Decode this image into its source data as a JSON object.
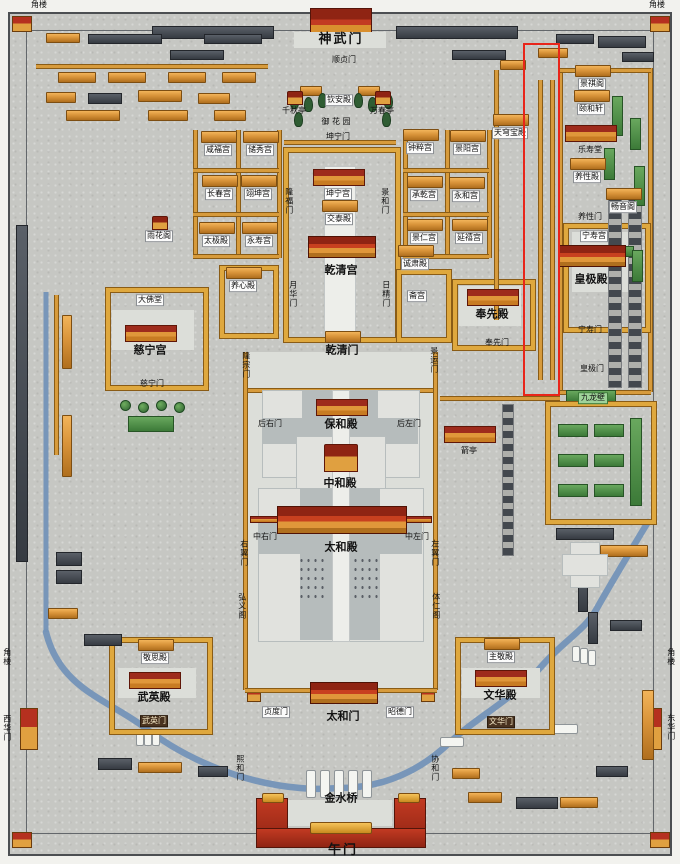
{
  "map": {
    "palette": {
      "ground": "#c6c7c3",
      "building_orange": "#d9943a",
      "roof_red": "#9e2b1c",
      "roof_dark": "#3f444a",
      "roof_green": "#3c7a38",
      "river_blue": "#7494b8",
      "marble": "#e1e2de",
      "annotation_red": "#e8251a"
    },
    "annotation_box": {
      "x": 523,
      "y": 43,
      "width": 33,
      "height": 349
    },
    "labels": [
      {
        "t": "角楼",
        "x": 39,
        "y": 5,
        "s": "t"
      },
      {
        "t": "角楼",
        "x": 657,
        "y": 5,
        "s": "t"
      },
      {
        "t": "角楼",
        "x": 7,
        "y": 657,
        "s": "t",
        "o": "v"
      },
      {
        "t": "角楼",
        "x": 671,
        "y": 657,
        "s": "t",
        "o": "v"
      },
      {
        "t": "西华门",
        "x": 7,
        "y": 728,
        "s": "t",
        "o": "v"
      },
      {
        "t": "东华门",
        "x": 671,
        "y": 727,
        "s": "t",
        "o": "v"
      },
      {
        "t": "神武门",
        "x": 341,
        "y": 40,
        "s": "h"
      },
      {
        "t": "顺贞门",
        "x": 344,
        "y": 60,
        "s": "t"
      },
      {
        "t": "钦安殿",
        "x": 339,
        "y": 100,
        "s": "p"
      },
      {
        "t": "千秋亭",
        "x": 294,
        "y": 111,
        "s": "t",
        "i": "pav"
      },
      {
        "t": "万春亭",
        "x": 382,
        "y": 111,
        "s": "t",
        "i": "pav"
      },
      {
        "t": "御 花 园",
        "x": 336,
        "y": 122,
        "s": "t"
      },
      {
        "t": "坤宁门",
        "x": 338,
        "y": 137,
        "s": "t"
      },
      {
        "t": "天穹宝殿",
        "x": 510,
        "y": 133,
        "s": "p",
        "i": "hall"
      },
      {
        "t": "咸福宫",
        "x": 218,
        "y": 150,
        "s": "p",
        "i": "hall"
      },
      {
        "t": "储秀宫",
        "x": 260,
        "y": 150,
        "s": "p",
        "i": "hall"
      },
      {
        "t": "钟粹宫",
        "x": 420,
        "y": 148,
        "s": "p",
        "i": "hall"
      },
      {
        "t": "景阳宫",
        "x": 467,
        "y": 149,
        "s": "p",
        "i": "hall"
      },
      {
        "t": "景祺阁",
        "x": 592,
        "y": 84,
        "s": "p",
        "i": "hall"
      },
      {
        "t": "颐和轩",
        "x": 591,
        "y": 109,
        "s": "p",
        "i": "hall"
      },
      {
        "t": "长春宫",
        "x": 219,
        "y": 194,
        "s": "p",
        "i": "hall"
      },
      {
        "t": "翊坤宫",
        "x": 258,
        "y": 194,
        "s": "p",
        "i": "hall"
      },
      {
        "t": "承乾宫",
        "x": 424,
        "y": 195,
        "s": "p",
        "i": "hall"
      },
      {
        "t": "永和宫",
        "x": 466,
        "y": 196,
        "s": "p",
        "i": "hall"
      },
      {
        "t": "乐寿堂",
        "x": 590,
        "y": 150,
        "s": "t",
        "i": "hallR"
      },
      {
        "t": "养性殿",
        "x": 587,
        "y": 177,
        "s": "p",
        "i": "hall"
      },
      {
        "t": "太极殿",
        "x": 216,
        "y": 241,
        "s": "p",
        "i": "hall"
      },
      {
        "t": "永寿宫",
        "x": 259,
        "y": 241,
        "s": "p",
        "i": "hall"
      },
      {
        "t": "景仁宫",
        "x": 424,
        "y": 238,
        "s": "p",
        "i": "hall"
      },
      {
        "t": "延禧宫",
        "x": 469,
        "y": 238,
        "s": "p",
        "i": "hall"
      },
      {
        "t": "雨花阁",
        "x": 159,
        "y": 236,
        "s": "p",
        "i": "pav"
      },
      {
        "t": "坤宁宫",
        "x": 338,
        "y": 194,
        "s": "p",
        "i": "hallR"
      },
      {
        "t": "交泰殿",
        "x": 339,
        "y": 219,
        "s": "p",
        "i": "hall"
      },
      {
        "t": "养性门",
        "x": 590,
        "y": 217,
        "s": "t"
      },
      {
        "t": "畅音阁",
        "x": 623,
        "y": 207,
        "s": "p",
        "i": "hall"
      },
      {
        "t": "宁寿宫",
        "x": 594,
        "y": 236,
        "s": "p"
      },
      {
        "t": "乾清宫",
        "x": 341,
        "y": 270,
        "s": "b",
        "i": "hallB"
      },
      {
        "t": "养心殿",
        "x": 243,
        "y": 286,
        "s": "p",
        "i": "hall"
      },
      {
        "t": "诚肃殿",
        "x": 415,
        "y": 264,
        "s": "p",
        "i": "hall"
      },
      {
        "t": "斋宫",
        "x": 417,
        "y": 296,
        "s": "p"
      },
      {
        "t": "大佛堂",
        "x": 150,
        "y": 300,
        "s": "p"
      },
      {
        "t": "皇极殿",
        "x": 591,
        "y": 279,
        "s": "b",
        "i": "hallB"
      },
      {
        "t": "奉先殿",
        "x": 492,
        "y": 314,
        "s": "b",
        "i": "hallR"
      },
      {
        "t": "月华门",
        "x": 293,
        "y": 294,
        "s": "t",
        "o": "v"
      },
      {
        "t": "日精门",
        "x": 386,
        "y": 294,
        "s": "t",
        "o": "v"
      },
      {
        "t": "隆福门",
        "x": 289,
        "y": 201,
        "s": "t",
        "o": "v"
      },
      {
        "t": "景和门",
        "x": 385,
        "y": 201,
        "s": "t",
        "o": "v"
      },
      {
        "t": "慈宁宫",
        "x": 150,
        "y": 350,
        "s": "b",
        "i": "hallR"
      },
      {
        "t": "乾清门",
        "x": 342,
        "y": 350,
        "s": "b",
        "i": "hall"
      },
      {
        "t": "奉先门",
        "x": 497,
        "y": 343,
        "s": "t"
      },
      {
        "t": "宁寿门",
        "x": 590,
        "y": 330,
        "s": "t"
      },
      {
        "t": "皇极门",
        "x": 592,
        "y": 369,
        "s": "t"
      },
      {
        "t": "慈宁门",
        "x": 152,
        "y": 384,
        "s": "t"
      },
      {
        "t": "九龙壁",
        "x": 593,
        "y": 398,
        "s": "g"
      },
      {
        "t": "隆宗门",
        "x": 246,
        "y": 365,
        "s": "t",
        "o": "v"
      },
      {
        "t": "景运门",
        "x": 434,
        "y": 360,
        "s": "t",
        "o": "v"
      },
      {
        "t": "保和殿",
        "x": 341,
        "y": 424,
        "s": "b",
        "i": "hallR"
      },
      {
        "t": "后右门",
        "x": 270,
        "y": 424,
        "s": "t"
      },
      {
        "t": "后左门",
        "x": 409,
        "y": 424,
        "s": "t"
      },
      {
        "t": "中和殿",
        "x": 340,
        "y": 483,
        "s": "b",
        "i": "pavB"
      },
      {
        "t": "中右门",
        "x": 265,
        "y": 537,
        "s": "t"
      },
      {
        "t": "中左门",
        "x": 417,
        "y": 537,
        "s": "t"
      },
      {
        "t": "太和殿",
        "x": 341,
        "y": 547,
        "s": "b",
        "i": "hallX"
      },
      {
        "t": "左翼门",
        "x": 435,
        "y": 553,
        "s": "t",
        "o": "v"
      },
      {
        "t": "右翼门",
        "x": 244,
        "y": 553,
        "s": "t",
        "o": "v"
      },
      {
        "t": "弘义阁",
        "x": 242,
        "y": 606,
        "s": "t",
        "o": "v"
      },
      {
        "t": "体仁阁",
        "x": 436,
        "y": 606,
        "s": "t",
        "o": "v"
      },
      {
        "t": "箭亭",
        "x": 469,
        "y": 451,
        "s": "t",
        "i": "hallR"
      },
      {
        "t": "敬思殿",
        "x": 155,
        "y": 658,
        "s": "p",
        "i": "hall"
      },
      {
        "t": "主敬殿",
        "x": 501,
        "y": 657,
        "s": "p",
        "i": "hall"
      },
      {
        "t": "武英殿",
        "x": 154,
        "y": 697,
        "s": "b",
        "i": "hallR"
      },
      {
        "t": "文华殿",
        "x": 500,
        "y": 695,
        "s": "b",
        "i": "hallR"
      },
      {
        "t": "武英门",
        "x": 154,
        "y": 721,
        "s": "d"
      },
      {
        "t": "文华门",
        "x": 501,
        "y": 722,
        "s": "d"
      },
      {
        "t": "熙和门",
        "x": 240,
        "y": 768,
        "s": "t",
        "o": "v"
      },
      {
        "t": "协和门",
        "x": 435,
        "y": 768,
        "s": "t",
        "o": "v"
      },
      {
        "t": "贞度门",
        "x": 276,
        "y": 712,
        "s": "p"
      },
      {
        "t": "太和门",
        "x": 343,
        "y": 716,
        "s": "b",
        "i": "hallB"
      },
      {
        "t": "昭德门",
        "x": 400,
        "y": 712,
        "s": "p"
      },
      {
        "t": "金水桥",
        "x": 341,
        "y": 798,
        "s": "b"
      },
      {
        "t": "午门",
        "x": 343,
        "y": 851,
        "s": "h"
      }
    ]
  }
}
